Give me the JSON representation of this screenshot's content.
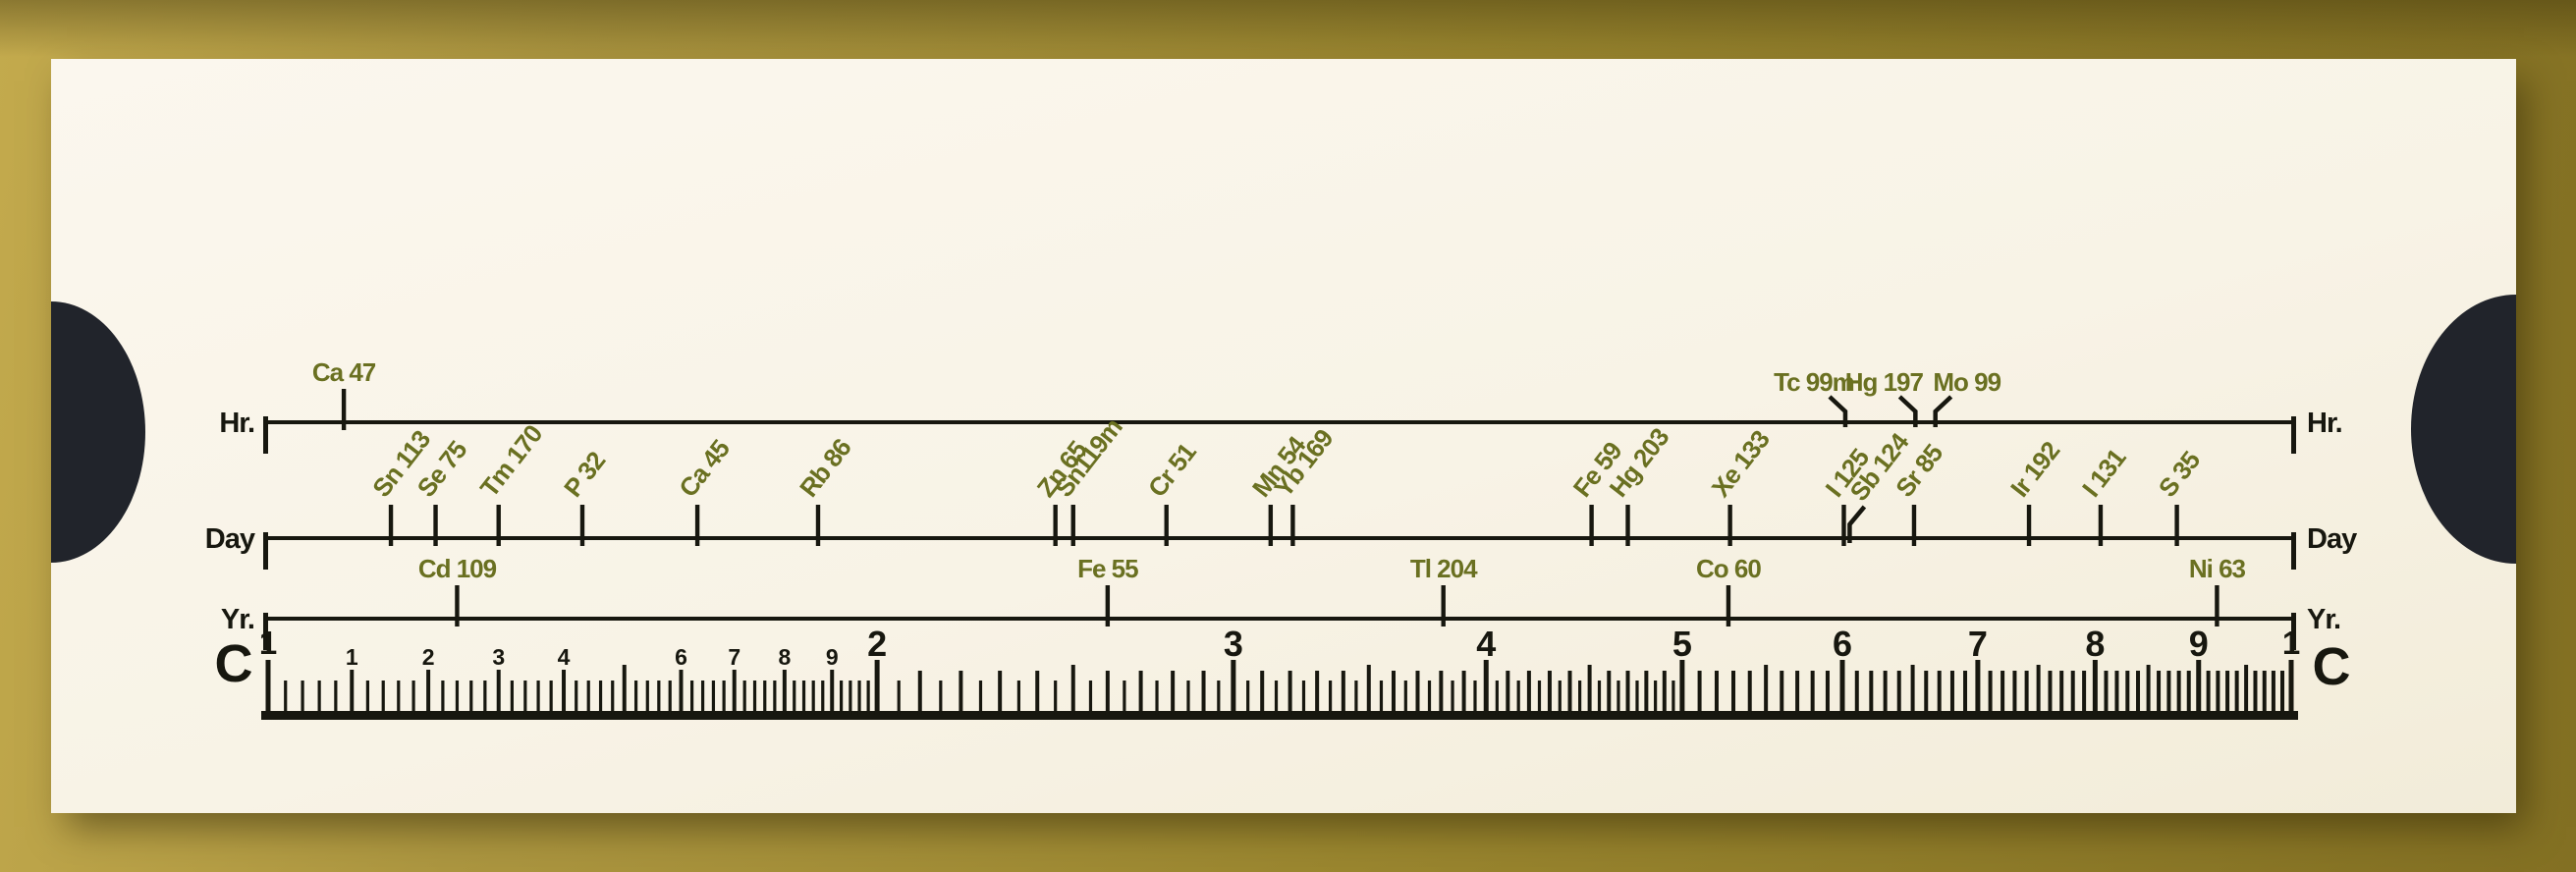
{
  "colors": {
    "background_gold": "#a8923c",
    "card_cream": "#f8f3e6",
    "thumb_cutout_black": "#21242b",
    "ink_black": "#17170f",
    "isotope_olive_green": "#6a7021"
  },
  "slide_chart": {
    "scales": [
      {
        "id": "hr",
        "left_label": "Hr.",
        "right_label": "Hr.",
        "isotopes": [
          {
            "name": "Ca 47",
            "c_value": 1.09,
            "style": "flag"
          },
          {
            "name": "Tc 99m",
            "c_value": 6.02,
            "style": "leader",
            "side": -1
          },
          {
            "name": "Hg 197",
            "c_value": 6.52,
            "style": "leader",
            "side": -1
          },
          {
            "name": "Mo 99",
            "c_value": 6.67,
            "style": "leader",
            "side": 1
          }
        ]
      },
      {
        "id": "day",
        "left_label": "Day",
        "right_label": "Day",
        "isotopes": [
          {
            "name": "Sn 113",
            "c_value": 1.15,
            "style": "rotated"
          },
          {
            "name": "Se 75",
            "c_value": 1.21,
            "style": "rotated"
          },
          {
            "name": "Tm 170",
            "c_value": 1.3,
            "style": "rotated"
          },
          {
            "name": "P 32",
            "c_value": 1.43,
            "style": "rotated"
          },
          {
            "name": "Ca 45",
            "c_value": 1.63,
            "style": "rotated"
          },
          {
            "name": "Rb 86",
            "c_value": 1.87,
            "style": "rotated"
          },
          {
            "name": "Zn 65",
            "c_value": 2.45,
            "style": "rotated"
          },
          {
            "name": "Sn119m",
            "c_value": 2.5,
            "style": "rotated"
          },
          {
            "name": "Cr 51",
            "c_value": 2.78,
            "style": "rotated"
          },
          {
            "name": "Mn 54",
            "c_value": 3.13,
            "style": "rotated"
          },
          {
            "name": "Yb 169",
            "c_value": 3.21,
            "style": "rotated"
          },
          {
            "name": "Fe 59",
            "c_value": 4.51,
            "style": "rotated"
          },
          {
            "name": "Hg 203",
            "c_value": 4.7,
            "style": "rotated"
          },
          {
            "name": "Xe 133",
            "c_value": 5.28,
            "style": "rotated"
          },
          {
            "name": "I 125",
            "c_value": 6.01,
            "style": "rotated"
          },
          {
            "name": "Sb 124",
            "c_value": 6.05,
            "style": "rotated-offset"
          },
          {
            "name": "Sr 85",
            "c_value": 6.51,
            "style": "rotated"
          },
          {
            "name": "Ir 192",
            "c_value": 7.42,
            "style": "rotated"
          },
          {
            "name": "I 131",
            "c_value": 8.05,
            "style": "rotated"
          },
          {
            "name": "S 35",
            "c_value": 8.78,
            "style": "rotated"
          }
        ]
      },
      {
        "id": "yr",
        "left_label": "Yr.",
        "right_label": "Yr.",
        "isotopes": [
          {
            "name": "Cd 109",
            "c_value": 1.24,
            "style": "flag"
          },
          {
            "name": "Fe 55",
            "c_value": 2.6,
            "style": "flag"
          },
          {
            "name": "Tl 204",
            "c_value": 3.81,
            "style": "flag"
          },
          {
            "name": "Co 60",
            "c_value": 5.27,
            "style": "flag"
          },
          {
            "name": "Ni 63",
            "c_value": 9.19,
            "style": "flag"
          }
        ]
      }
    ],
    "c_scale": {
      "left_label": "C",
      "right_label": "C",
      "end_label": "1",
      "major_labels": [
        "2",
        "3",
        "4",
        "5",
        "6",
        "7",
        "8",
        "9"
      ],
      "decimal_labels": [
        "1",
        "2",
        "3",
        "4",
        "5",
        "6",
        "7",
        "8",
        "9"
      ]
    }
  },
  "chart_data": {
    "type": "scatter",
    "xscale": "log",
    "xlim": [
      1,
      10
    ],
    "series": [
      {
        "name": "Hr. scale",
        "points": [
          [
            "Ca 47",
            1.09
          ],
          [
            "Tc 99m",
            6.02
          ],
          [
            "Hg 197",
            6.52
          ],
          [
            "Mo 99",
            6.67
          ]
        ]
      },
      {
        "name": "Day scale",
        "points": [
          [
            "Sn 113",
            1.15
          ],
          [
            "Se 75",
            1.21
          ],
          [
            "Tm 170",
            1.3
          ],
          [
            "P 32",
            1.43
          ],
          [
            "Ca 45",
            1.63
          ],
          [
            "Rb 86",
            1.87
          ],
          [
            "Zn 65",
            2.45
          ],
          [
            "Sn119m",
            2.5
          ],
          [
            "Cr 51",
            2.78
          ],
          [
            "Mn 54",
            3.13
          ],
          [
            "Yb 169",
            3.21
          ],
          [
            "Fe 59",
            4.51
          ],
          [
            "Hg 203",
            4.7
          ],
          [
            "Xe 133",
            5.28
          ],
          [
            "I 125",
            6.01
          ],
          [
            "Sb 124",
            6.05
          ],
          [
            "Sr 85",
            6.51
          ],
          [
            "Ir 192",
            7.42
          ],
          [
            "I 131",
            8.05
          ],
          [
            "S 35",
            8.78
          ]
        ]
      },
      {
        "name": "Yr. scale",
        "points": [
          [
            "Cd 109",
            1.24
          ],
          [
            "Fe 55",
            2.6
          ],
          [
            "Tl 204",
            3.81
          ],
          [
            "Co 60",
            5.27
          ],
          [
            "Ni 63",
            9.19
          ]
        ]
      }
    ]
  }
}
